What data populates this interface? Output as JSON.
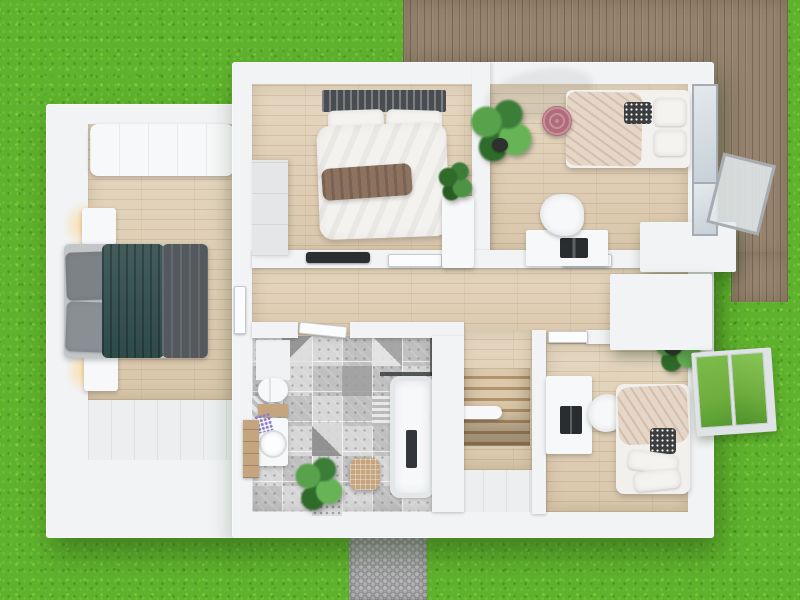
{
  "scene": {
    "title": "Top-down 3D render of an upper-floor apartment plan",
    "setting": "White-walled flat with light wood floors, surrounded by lawn, wooden roof terrace at top right, cobblestone path at bottom",
    "palette": {
      "grass": "#5fb32c",
      "deck": "#95836e",
      "deck-line": "rgba(58,45,30,0.32)",
      "path": "#a4a4a6",
      "wall": "#f2f3f5",
      "floor": "#e0cfb4",
      "floor-line": "rgba(150,115,80,0.20)",
      "tile-a": "#c0c0c0",
      "tile-b": "#d7d7d7",
      "bed-teal": "#2e4a49",
      "fabric-dark": "#54595e",
      "fabric-gray": "#7d8287",
      "bedding-white": "#f5f3f0",
      "bedding-beige": "#e6d6c7",
      "throw": "#8e7260",
      "plant-a": "#3c7d38",
      "plant-b": "#58a24b",
      "pot": "#2d302e",
      "pink": "#b26b79",
      "laptop": "#2a2d30",
      "frame": "#a6acb1",
      "glass-green": "#6fae3e",
      "wood-cab": "#c4a57e",
      "glow": "rgba(255,215,145,0.95)"
    },
    "environment": {
      "lawn": "grass lawn",
      "terrace": "wooden deck terrace",
      "walkway": "cobblestone path"
    },
    "rooms": [
      {
        "id": "master-bedroom",
        "position": "left wing",
        "furniture": [
          "white upholstered sofa along top wall",
          "double bed with dark teal duvet and grey drape",
          "grey pillows",
          "two nightstands with lit lamps",
          "built-in closet strip"
        ]
      },
      {
        "id": "bedroom-top-middle",
        "position": "top middle",
        "furniture": [
          "bed with dark slatted headboard",
          "white duvet with brown throw",
          "white pillows",
          "wardrobe",
          "potted plant on white pedestal",
          "dark wall shelf"
        ]
      },
      {
        "id": "bedroom-top-right",
        "position": "top right",
        "furniture": [
          "single bed with beige and white bedding",
          "black-and-white patterned cushion",
          "pink knitted pouf",
          "fiddle-leaf fig plant",
          "desk with laptop",
          "white swivel chair",
          "corner window open to deck"
        ]
      },
      {
        "id": "bathroom",
        "position": "center bottom",
        "furniture": [
          "patchwork grey tile floor",
          "toilet",
          "wooden vanity with round basin",
          "lavender posy",
          "tall wooden cabinet",
          "bathtub with dark glass screen and shower column",
          "wicker laundry basket",
          "potted plant"
        ]
      },
      {
        "id": "bedroom-bottom-right",
        "position": "bottom right",
        "furniture": [
          "desk with laptop against wall",
          "white chair",
          "single bed with beige duvet and white pillows",
          "potted plant",
          "window open to garden"
        ]
      },
      {
        "id": "hallway-landing",
        "position": "center",
        "furniture": [
          "wood staircase going down",
          "white handrail",
          "white interior doors"
        ]
      }
    ]
  }
}
